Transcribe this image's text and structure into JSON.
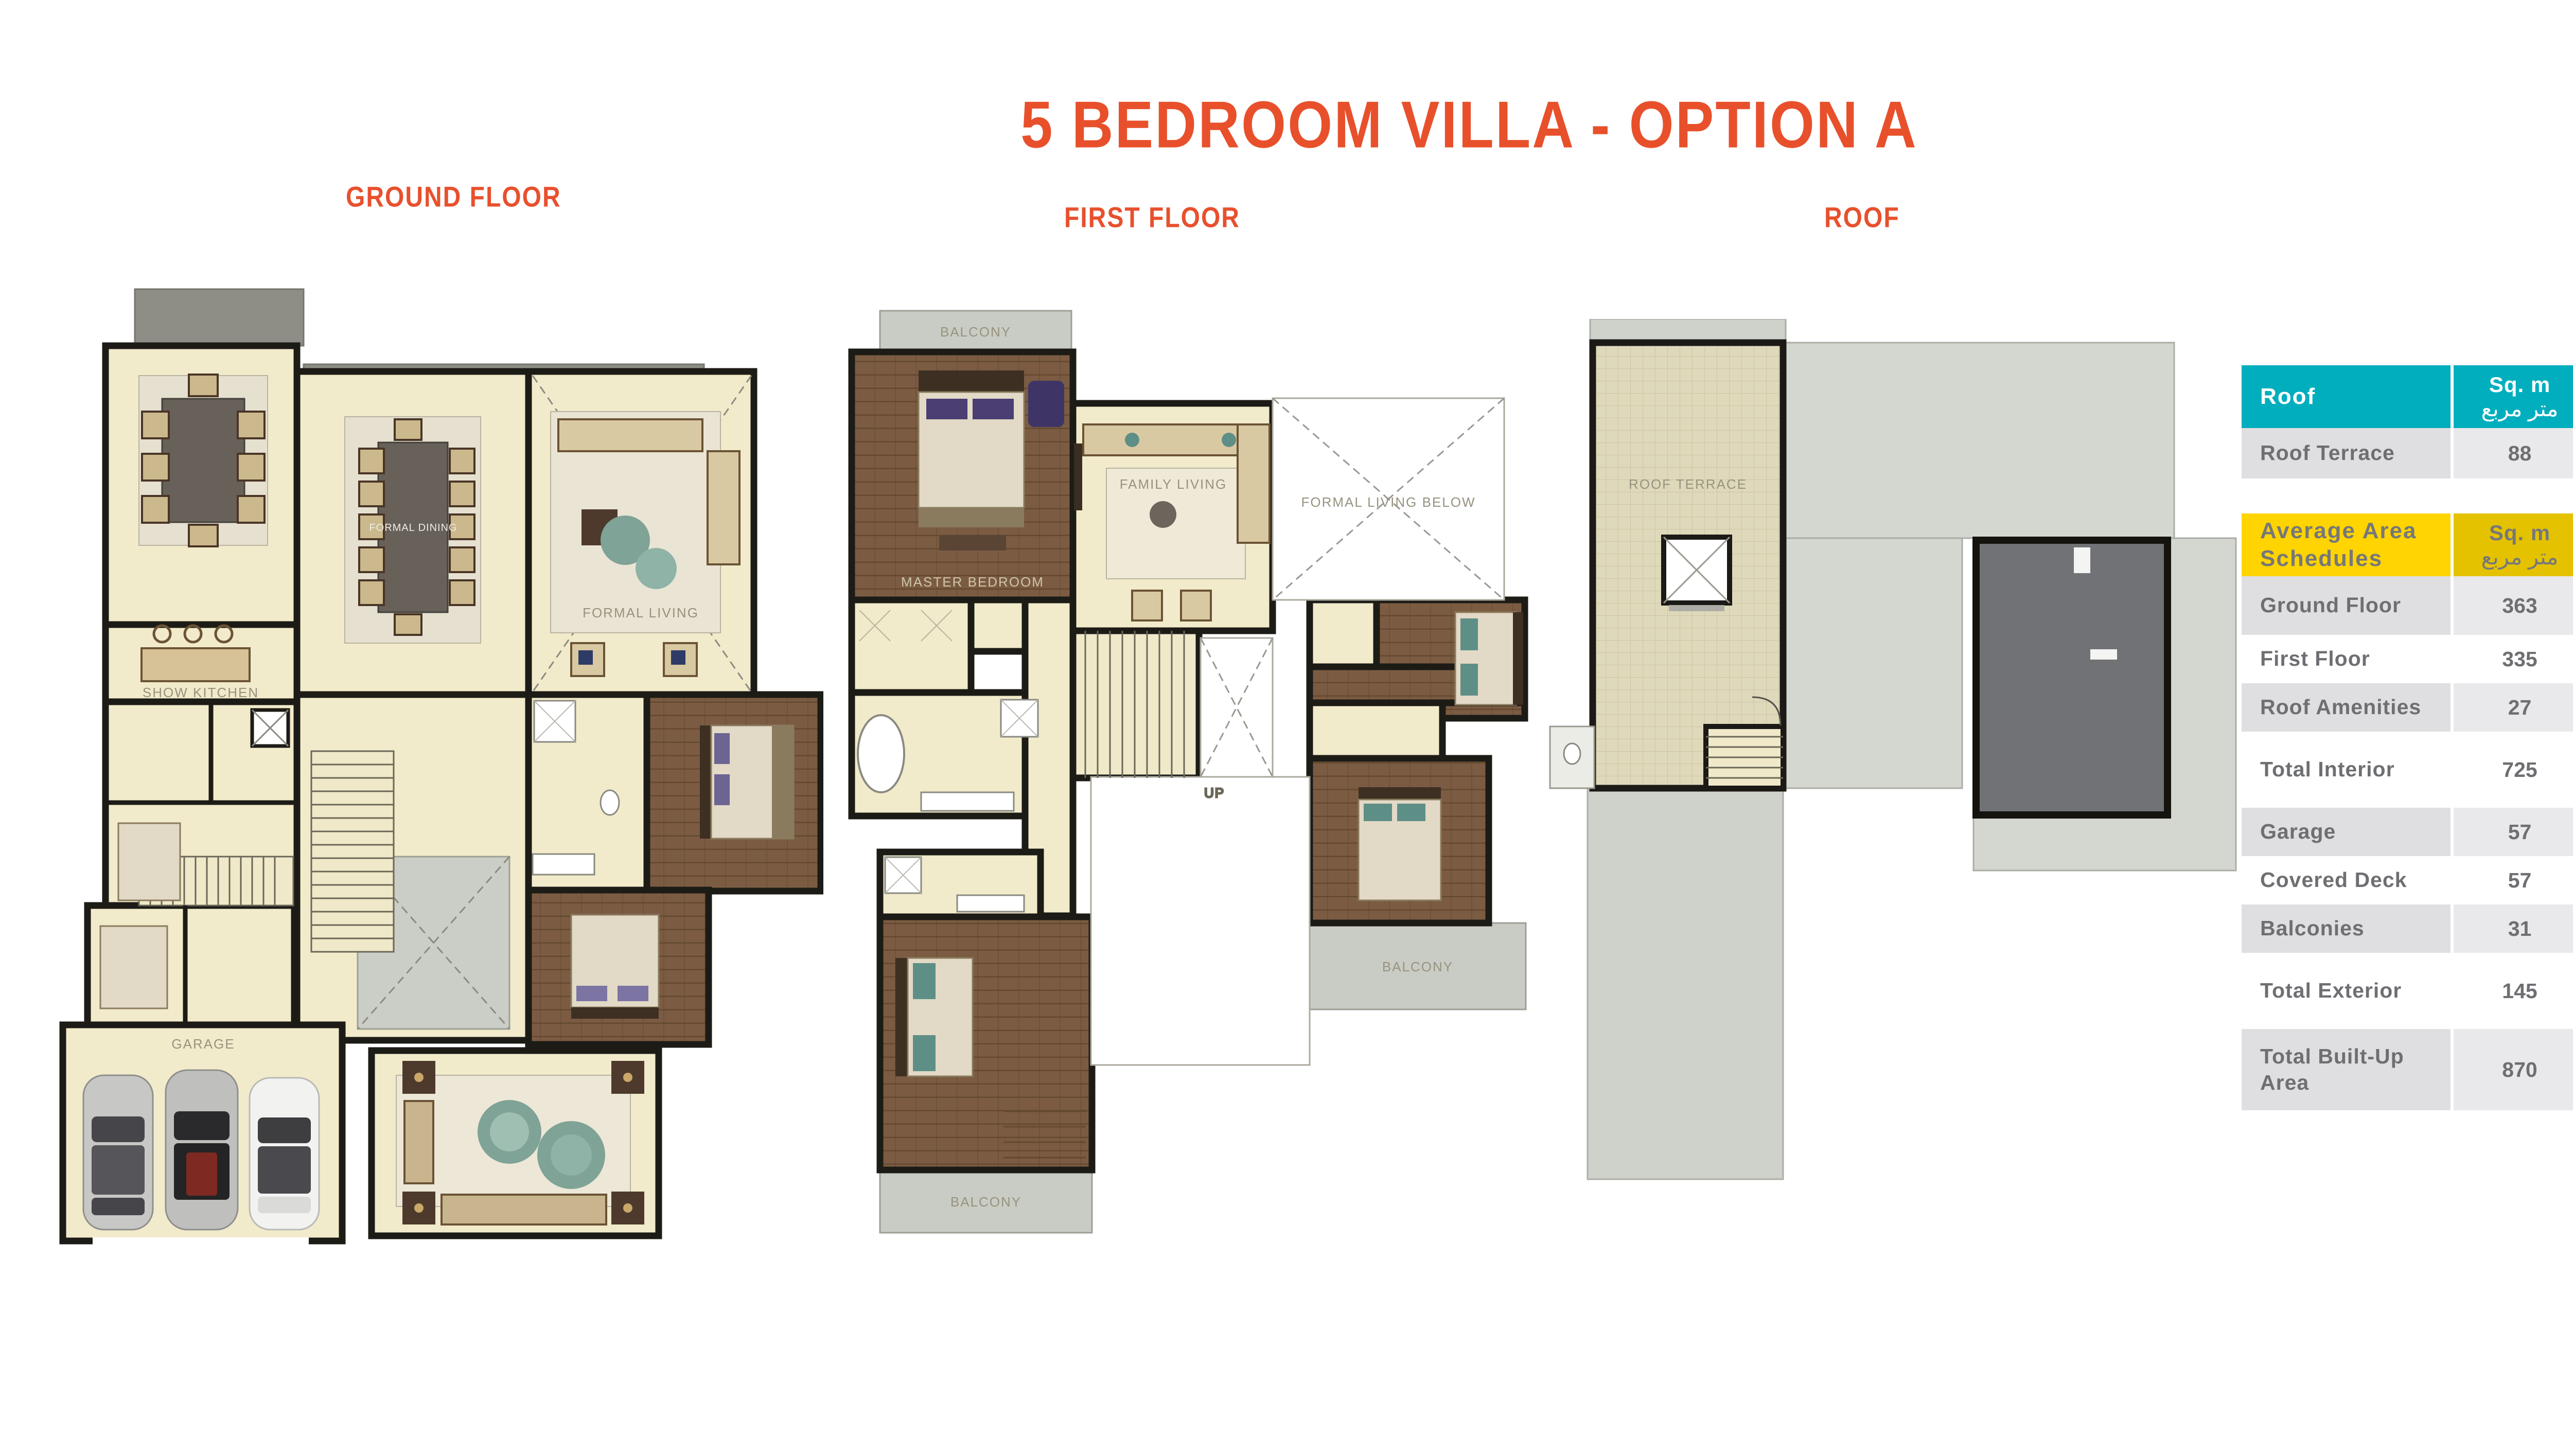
{
  "page": {
    "title": "5 BEDROOM VILLA - OPTION A"
  },
  "floors": {
    "ground": "GROUND FLOOR",
    "first": "FIRST FLOOR",
    "roof": "ROOF"
  },
  "plans": {
    "ground": {
      "labels": {
        "formal_dining": "FORMAL DINING",
        "formal_living": "FORMAL LIVING",
        "show_kitchen": "SHOW KITCHEN",
        "garage": "GARAGE"
      }
    },
    "first": {
      "labels": {
        "balcony": "BALCONY",
        "master_bedroom": "MASTER BEDROOM",
        "family_living": "FAMILY LIVING",
        "formal_living_below": "FORMAL LIVING BELOW",
        "up": "UP"
      }
    },
    "roof": {
      "labels": {
        "roof_terrace": "ROOF TERRACE"
      }
    }
  },
  "tables": {
    "roof": {
      "header": {
        "title": "Roof",
        "sqm_en": "Sq. m",
        "sqm_ar": "متر مربع",
        "sqft_en": "Sq. ft",
        "sqft_ar": "قدم مربع",
        "title_ar": "الروف"
      },
      "rows": [
        {
          "label": "Roof Terrace",
          "sqm": "88",
          "sqft": "947",
          "ar": "تراس السطح"
        }
      ]
    },
    "schedule": {
      "header": {
        "title": "Average Area Schedules",
        "sqm_en": "Sq. m",
        "sqm_ar": "متر مربع",
        "sqft_en": "Sq. ft",
        "sqft_ar": "قدم مربع",
        "title_ar": "المكان"
      },
      "rows": [
        {
          "label": "Ground Floor",
          "sqm": "363",
          "sqft": "3905",
          "ar": "الطابق الأرضي"
        },
        {
          "label": "First Floor",
          "sqm": "335",
          "sqft": "3606",
          "ar": "الطابق الأول"
        },
        {
          "label": "Roof Amenities",
          "sqm": "27",
          "sqft": "291",
          "ar": "مرافق الروف"
        },
        {
          "label": "Total Interior",
          "sqm": "725",
          "sqft": "7802",
          "ar": "إجمالي المساحة الداخلية"
        },
        {
          "label": "Garage",
          "sqm": "57",
          "sqft": "609",
          "ar": "المرآب"
        },
        {
          "label": "Covered Deck",
          "sqm": "57",
          "sqft": "617",
          "ar": "السطح المغطى"
        },
        {
          "label": "Balconies",
          "sqm": "31",
          "sqft": "336",
          "ar": "الشرفات"
        },
        {
          "label": "Total Exterior",
          "sqm": "145",
          "sqft": "1562",
          "ar": "إجمالي المساحة المبنية"
        },
        {
          "label": "Total Built-Up Area",
          "sqm": "870",
          "sqft": "9364",
          "ar": "إجمالي المساحة المبنية"
        }
      ]
    }
  },
  "colors": {
    "accent_orange": "#E8502B",
    "teal": "#00AEBE",
    "teal_light": "#43BFCA",
    "yellow": "#FFD400",
    "yellow_dark": "#E4C200",
    "row_gray": "#DFDEE1",
    "row_gray_light": "#E9E8EB",
    "beige_room": "#F1EBCB",
    "wood_floor": "#7B5C43",
    "roof_gray": "#CDD0C8",
    "roof_dark": "#717275"
  }
}
